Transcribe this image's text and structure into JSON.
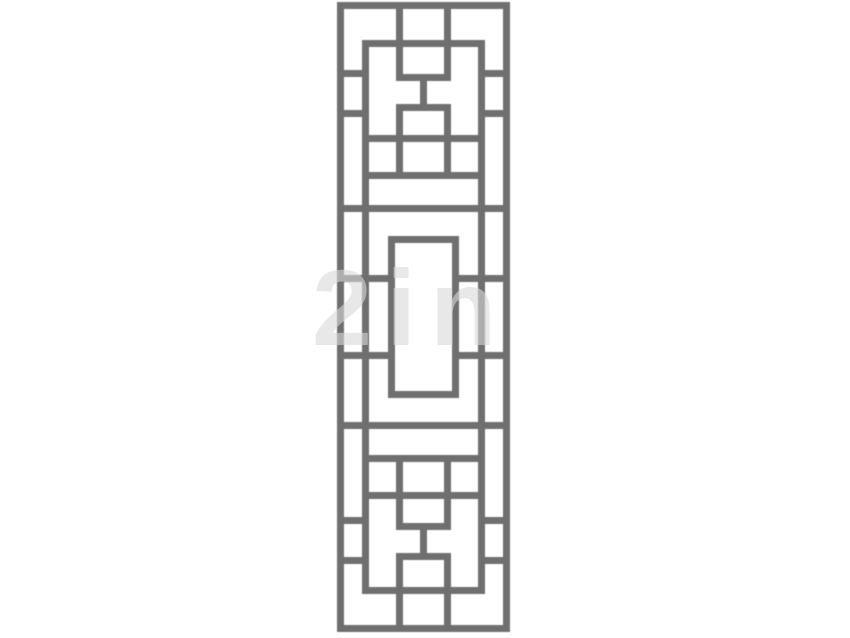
{
  "canvas": {
    "width": 850,
    "height": 638,
    "background": "#ffffff"
  },
  "lattice": {
    "description": "chinese-lattice-window-grille",
    "bar_color": "#6f6f6f",
    "bar_thickness": 7,
    "panel": {
      "left": 337,
      "top": 2,
      "width": 173,
      "height": 630
    },
    "h_bars": [
      {
        "y": 0,
        "x1": 0,
        "x2": 173
      },
      {
        "y": 38,
        "x1": 25,
        "x2": 148
      },
      {
        "y": 68,
        "x1": 0,
        "x2": 32
      },
      {
        "y": 68,
        "x1": 141,
        "x2": 173
      },
      {
        "y": 72,
        "x1": 59,
        "x2": 114
      },
      {
        "y": 102,
        "x1": 59,
        "x2": 114
      },
      {
        "y": 108,
        "x1": 0,
        "x2": 32
      },
      {
        "y": 108,
        "x1": 141,
        "x2": 173
      },
      {
        "y": 133,
        "x1": 25,
        "x2": 148
      },
      {
        "y": 170,
        "x1": 25,
        "x2": 148
      },
      {
        "y": 203,
        "x1": 0,
        "x2": 173
      },
      {
        "y": 234,
        "x1": 51,
        "x2": 122
      },
      {
        "y": 273,
        "x1": 0,
        "x2": 58
      },
      {
        "y": 273,
        "x1": 115,
        "x2": 173
      },
      {
        "y": 350,
        "x1": 0,
        "x2": 58
      },
      {
        "y": 350,
        "x1": 115,
        "x2": 173
      },
      {
        "y": 389,
        "x1": 51,
        "x2": 122
      },
      {
        "y": 420,
        "x1": 0,
        "x2": 173
      },
      {
        "y": 453,
        "x1": 25,
        "x2": 148
      },
      {
        "y": 490,
        "x1": 25,
        "x2": 148
      },
      {
        "y": 515,
        "x1": 0,
        "x2": 32
      },
      {
        "y": 515,
        "x1": 141,
        "x2": 173
      },
      {
        "y": 521,
        "x1": 59,
        "x2": 114
      },
      {
        "y": 551,
        "x1": 59,
        "x2": 114
      },
      {
        "y": 555,
        "x1": 0,
        "x2": 32
      },
      {
        "y": 555,
        "x1": 141,
        "x2": 173
      },
      {
        "y": 585,
        "x1": 25,
        "x2": 148
      },
      {
        "y": 623,
        "x1": 0,
        "x2": 173
      }
    ],
    "v_bars": [
      {
        "x": 0,
        "y1": 0,
        "y2": 630
      },
      {
        "x": 166,
        "y1": 0,
        "y2": 630
      },
      {
        "x": 25,
        "y1": 38,
        "y2": 592
      },
      {
        "x": 141,
        "y1": 38,
        "y2": 592
      },
      {
        "x": 59,
        "y1": 7,
        "y2": 72
      },
      {
        "x": 107,
        "y1": 7,
        "y2": 72
      },
      {
        "x": 83,
        "y1": 79,
        "y2": 102
      },
      {
        "x": 59,
        "y1": 109,
        "y2": 170
      },
      {
        "x": 107,
        "y1": 109,
        "y2": 170
      },
      {
        "x": 51,
        "y1": 234,
        "y2": 396
      },
      {
        "x": 115,
        "y1": 234,
        "y2": 396
      },
      {
        "x": 59,
        "y1": 460,
        "y2": 521
      },
      {
        "x": 107,
        "y1": 460,
        "y2": 521
      },
      {
        "x": 83,
        "y1": 528,
        "y2": 551
      },
      {
        "x": 59,
        "y1": 558,
        "y2": 623
      },
      {
        "x": 107,
        "y1": 558,
        "y2": 623
      }
    ]
  },
  "watermark": {
    "text": "2in",
    "color": "rgba(216,216,216,0.6)",
    "left": 312,
    "top": 254,
    "font_size": 108
  }
}
